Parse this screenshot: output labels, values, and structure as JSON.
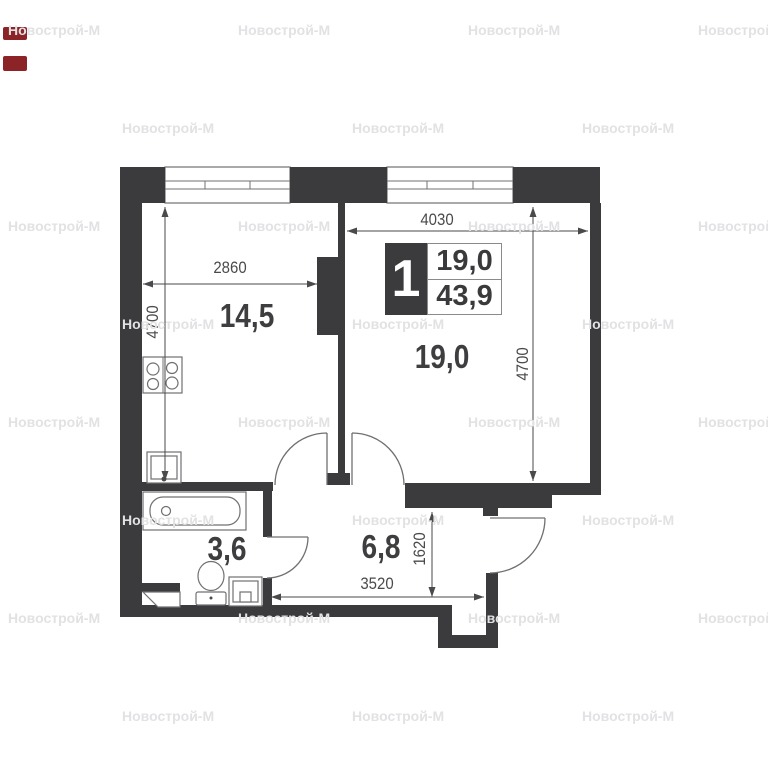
{
  "plan": {
    "info_badge": {
      "rooms_count": "1",
      "living_area": "19,0",
      "total_area": "43,9"
    },
    "rooms": [
      {
        "id": "kitchen-living",
        "area_label": "14,5"
      },
      {
        "id": "bedroom",
        "area_label": "19,0"
      },
      {
        "id": "bathroom",
        "area_label": "3,6"
      },
      {
        "id": "hallway",
        "area_label": "6,8"
      }
    ],
    "dimensions": {
      "kitchen_width": "2860",
      "kitchen_depth": "4700",
      "bedroom_width": "4030",
      "bedroom_depth": "4700",
      "hall_depth": "1620",
      "hall_width": "3520"
    },
    "icons": [
      "stove-icon",
      "sink-icon",
      "bathtub-icon",
      "toilet-icon",
      "washing-machine-icon",
      "vent-shaft-icon",
      "window-icon",
      "door-arc-icon"
    ],
    "colors": {
      "wall": "#3b3b3d",
      "line": "#707073",
      "dim": "#4a4a4c",
      "label": "#3e3e40",
      "watermark": "#e2e2e4",
      "edge_mark": "#8c2326"
    }
  },
  "watermarks": {
    "text": "Новострой-М",
    "positions": [
      [
        8,
        22
      ],
      [
        238,
        22
      ],
      [
        468,
        22
      ],
      [
        698,
        22
      ],
      [
        122,
        120
      ],
      [
        352,
        120
      ],
      [
        582,
        120
      ],
      [
        8,
        218
      ],
      [
        238,
        218
      ],
      [
        468,
        218
      ],
      [
        698,
        218
      ],
      [
        122,
        316
      ],
      [
        352,
        316
      ],
      [
        582,
        316
      ],
      [
        8,
        414
      ],
      [
        238,
        414
      ],
      [
        468,
        414
      ],
      [
        698,
        414
      ],
      [
        122,
        512
      ],
      [
        352,
        512
      ],
      [
        582,
        512
      ],
      [
        8,
        610
      ],
      [
        238,
        610
      ],
      [
        468,
        610
      ],
      [
        698,
        610
      ],
      [
        122,
        708
      ],
      [
        352,
        708
      ],
      [
        582,
        708
      ]
    ]
  }
}
